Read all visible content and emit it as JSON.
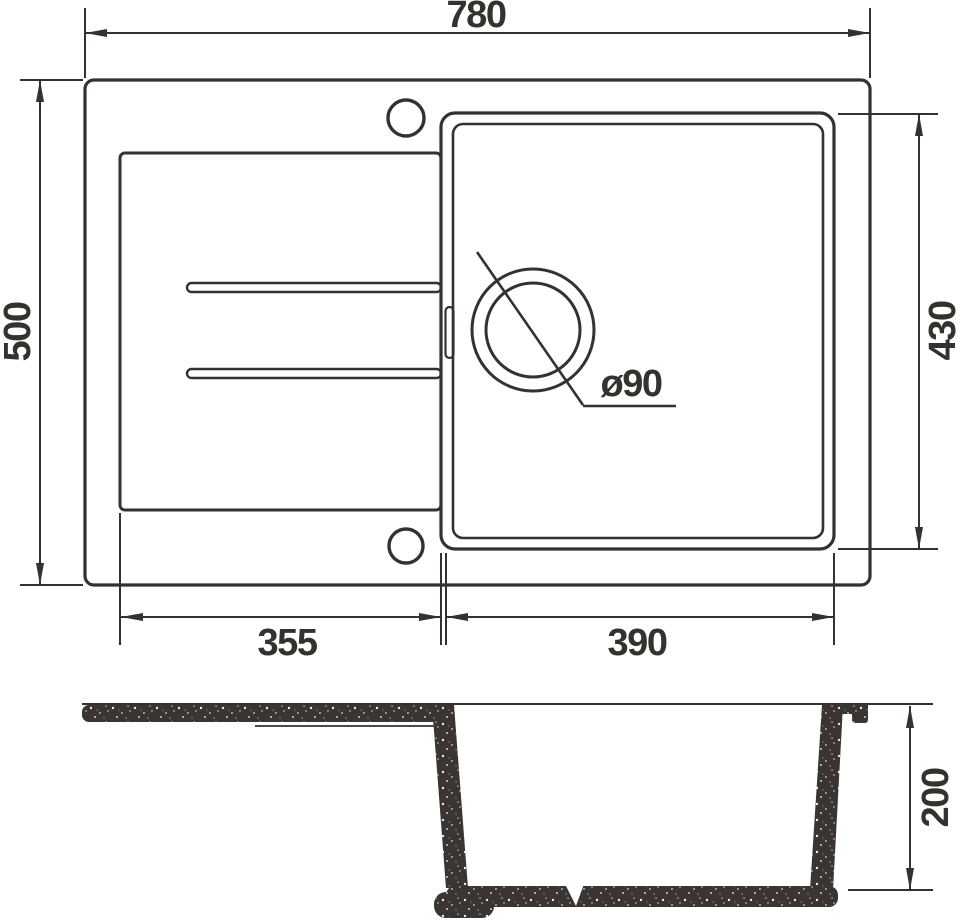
{
  "drawing": {
    "type": "sink-technical-drawing",
    "colors": {
      "line": "#35312d",
      "background": "#ffffff",
      "granite_base": "#3a3531",
      "speckle": "#ffffff"
    },
    "top_view": {
      "overall_width_label": "780",
      "overall_depth_label": "500",
      "bowl_depth_label": "430",
      "drainboard_width_label": "355",
      "bowl_width_label": "390",
      "drain_diameter_label": "ø90"
    },
    "section_view": {
      "bowl_height_label": "200"
    }
  }
}
